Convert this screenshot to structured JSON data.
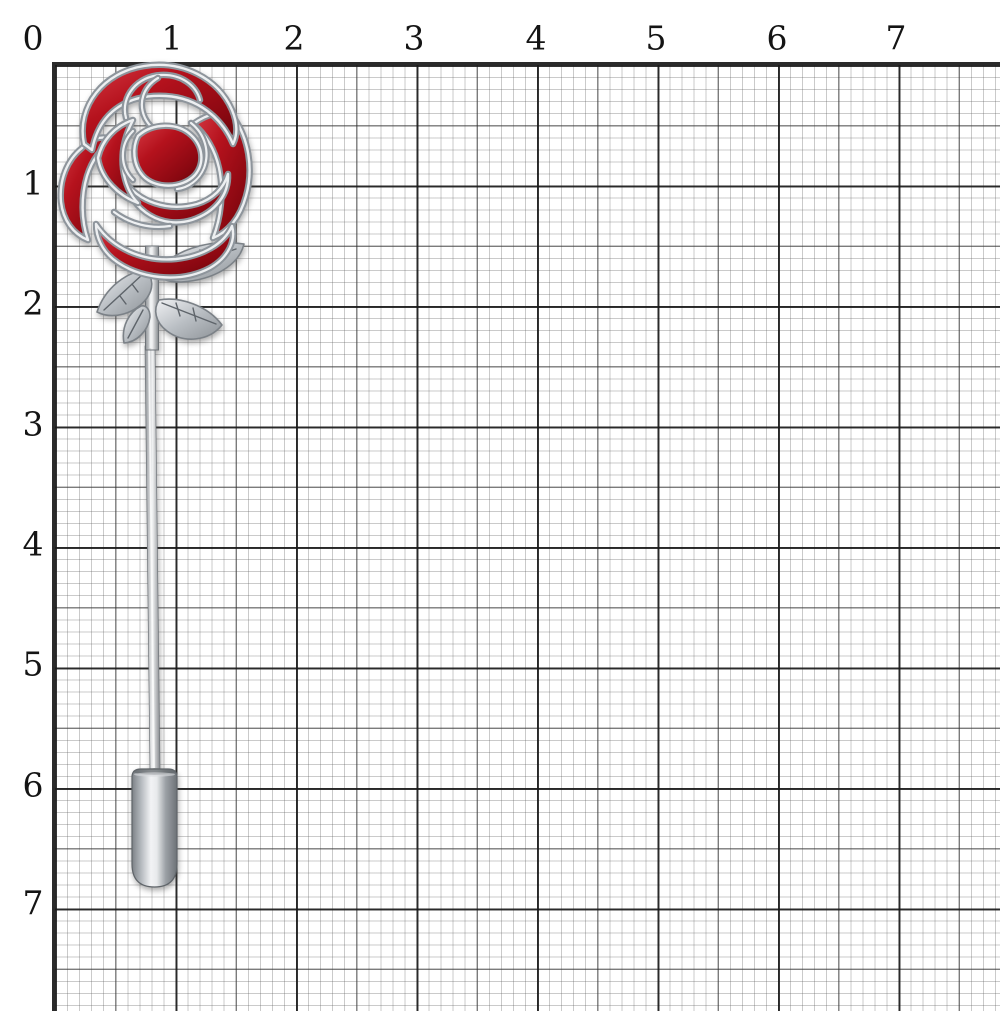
{
  "subject": "Red enamel rose lapel stick pin photographed on millimeter graph paper with centimeter ruler numerals",
  "ruler": {
    "top_labels": [
      "0",
      "1",
      "2",
      "3",
      "4",
      "5",
      "6",
      "7"
    ],
    "left_labels": [
      "1",
      "2",
      "3",
      "4",
      "5",
      "6",
      "7"
    ]
  },
  "colors": {
    "paper": "#ffffff",
    "grid_minor_line": "#b9b9b9",
    "grid_medium_line": "#6a6a6a",
    "grid_major_line": "#303030",
    "label_ink": "#141414",
    "enamel_red_bright": "#d63a44",
    "enamel_red_mid": "#b5121d",
    "enamel_red_dark": "#6e0409",
    "metal_light": "#f2f3f5",
    "metal_mid": "#b9bec3",
    "metal_dark": "#777c81"
  }
}
